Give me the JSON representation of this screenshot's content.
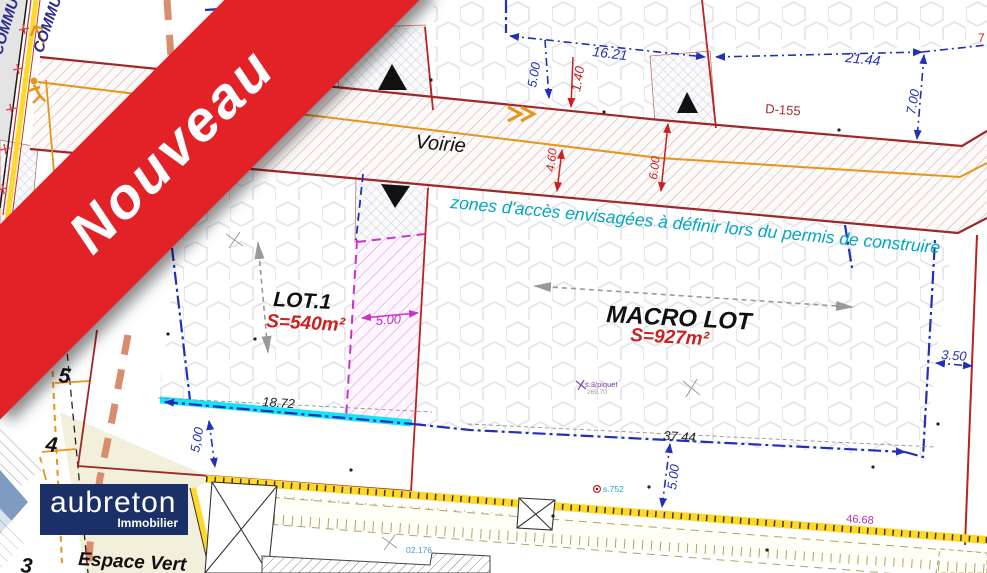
{
  "banner": {
    "label": "Nouveau",
    "color": "#e32227"
  },
  "logo": {
    "name": "aubreton",
    "tagline": "Immobilier",
    "bg": "#1c3068"
  },
  "plan": {
    "road_label": "Voirie",
    "access_note": "zones d'accès envisagées à définir lors du permis de construire",
    "boundary_label_1": "COMMU",
    "boundary_label_2": "COMMU",
    "parcel_ref": "D-155",
    "green_space_label": "Espace Vert",
    "lot1": {
      "title": "LOT.1",
      "area": "S=540m²"
    },
    "macro_lot": {
      "title": "MACRO LOT",
      "area": "S=927m²"
    },
    "parcel_numbers": {
      "p5": "5",
      "p4": "4",
      "p3": "3"
    },
    "dimensions": {
      "d500_tl": "5.00",
      "d1621": "16.21",
      "d500_mid": "5.00",
      "d140": "1.40",
      "d2144": "21.44",
      "d700": "7.00",
      "d460": "4.60",
      "d600": "6.00",
      "d500_mag": "5.00",
      "d1872": "18.72",
      "d3744": "37.44",
      "d350": "3.50",
      "d500_bl": "5,00",
      "d500_bm": "5.00",
      "d4668": "46.68",
      "d7edge": "7"
    },
    "point_labels": {
      "piquet": "s.3/piquet",
      "elev": "269.70",
      "s752": "s.752",
      "p02176": "02.176"
    },
    "colors": {
      "dim_blue": "#2030b8",
      "dim_red": "#cc2020",
      "boundary_darkred": "#9e2828",
      "magenta": "#cc2fd0",
      "note_cyan": "#00a7c0",
      "highlight_cyan": "#00e2f8",
      "fence_yellow": "#ffd928",
      "orange": "#e8941a",
      "green": "#3fa32b",
      "navy": "#1c3068",
      "banner_red": "#e32227"
    }
  }
}
